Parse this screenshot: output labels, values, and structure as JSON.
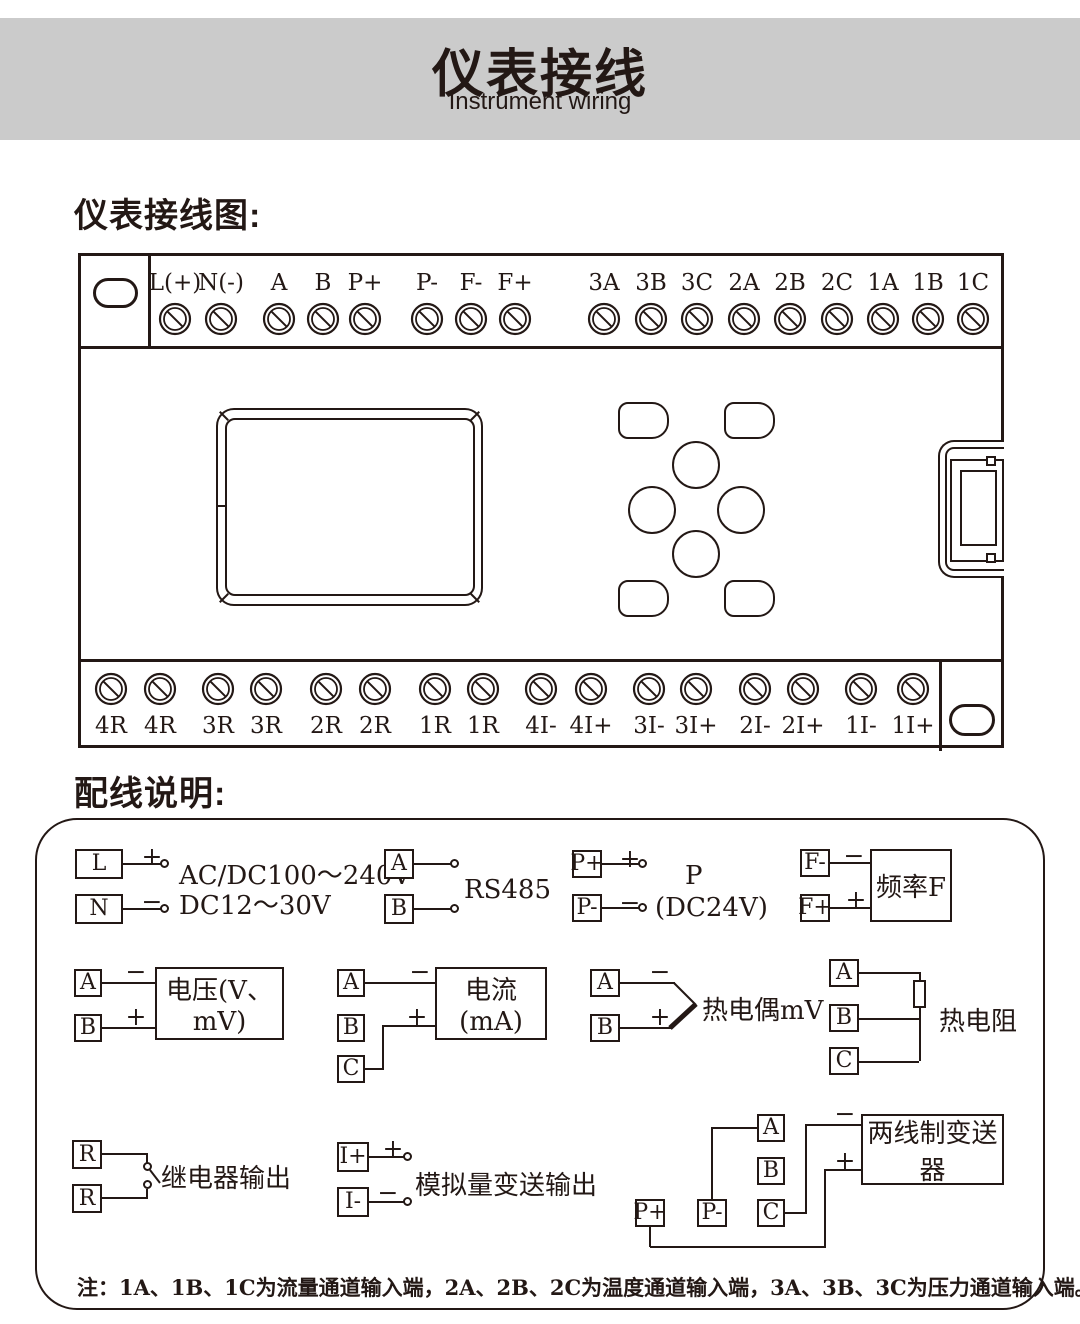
{
  "header": {
    "title": "仪表接线",
    "subtitle": "Instrument wiring"
  },
  "headings": {
    "diagram": "仪表接线图:",
    "wiring": "配线说明:"
  },
  "signs": {
    "plus": "+",
    "minus": "−"
  },
  "diagram": {
    "top_terminals": [
      "L(+)",
      "N(-)",
      "A",
      "B",
      "P+",
      "P-",
      "F-",
      "F+",
      "3A",
      "3B",
      "3C",
      "2A",
      "2B",
      "2C",
      "1A",
      "1B",
      "1C"
    ],
    "bottom_terminals": [
      "4R",
      "4R",
      "3R",
      "3R",
      "2R",
      "2R",
      "1R",
      "1R",
      "4I-",
      "4I+",
      "3I-",
      "3I+",
      "2I-",
      "2I+",
      "1I-",
      "1I+"
    ]
  },
  "wiring": {
    "power": {
      "t1": "L",
      "t2": "N",
      "line1": "AC/DC100～240V",
      "line2": "DC12～30V"
    },
    "rs485": {
      "t1": "A",
      "t2": "B",
      "label": "RS485"
    },
    "p24": {
      "t1": "P+",
      "t2": "P-",
      "line1": "P",
      "line2": "(DC24V)"
    },
    "freq": {
      "t1": "F-",
      "t2": "F+",
      "box": "频率F"
    },
    "voltage": {
      "t1": "A",
      "t2": "B",
      "box": "电压(V、mV)"
    },
    "current": {
      "t1": "A",
      "t2": "B",
      "t3": "C",
      "box": "电流(mA)"
    },
    "thermocouple": {
      "t1": "A",
      "t2": "B",
      "label": "热电偶mV"
    },
    "rtd": {
      "t1": "A",
      "t2": "B",
      "t3": "C",
      "label": "热电阻"
    },
    "relay": {
      "t1": "R",
      "t2": "R",
      "label": "继电器输出"
    },
    "analog_out": {
      "t1": "I+",
      "t2": "I-",
      "label": "模拟量变送输出"
    },
    "transmitter": {
      "t1": "A",
      "t2": "B",
      "t3": "C",
      "t4": "P+",
      "t5": "P-",
      "box": "两线制变送器"
    },
    "note": "注：1A、1B、1C为流量通道输入端，2A、2B、2C为温度通道输入端，3A、3B、3C为压力通道输入端。"
  },
  "colors": {
    "ink": "#231815",
    "band": "#cbcbcb"
  }
}
